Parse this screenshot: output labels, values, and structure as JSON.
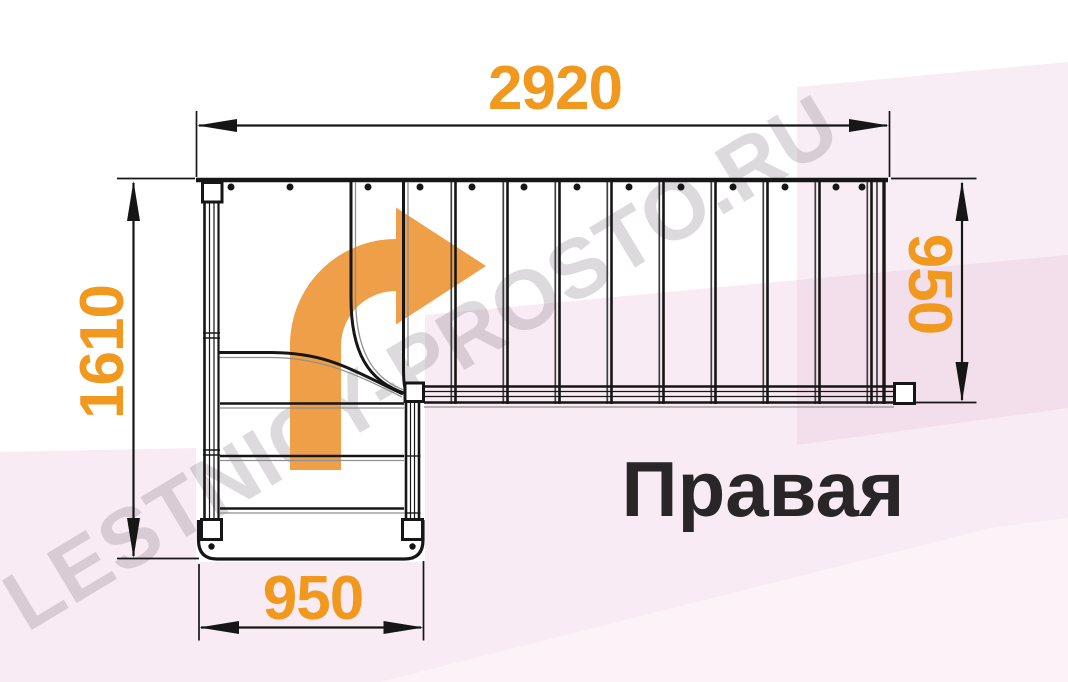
{
  "drawing": {
    "type": "staircase-floor-plan",
    "orientation_label": "Правая",
    "dimensions": {
      "top": "2920",
      "left": "1610",
      "right": "950",
      "bottom": "950"
    },
    "icons": {
      "direction_arrow": "turn-right-arrow"
    }
  },
  "watermark": {
    "text": "LESTNICY-PROSTO.RU"
  },
  "colors": {
    "dimension_text": "#F1981E",
    "direction_arrow": "#EF9F48",
    "line": "#161616",
    "title_text": "#2A2627",
    "pink_band": "#F7EAF2"
  }
}
